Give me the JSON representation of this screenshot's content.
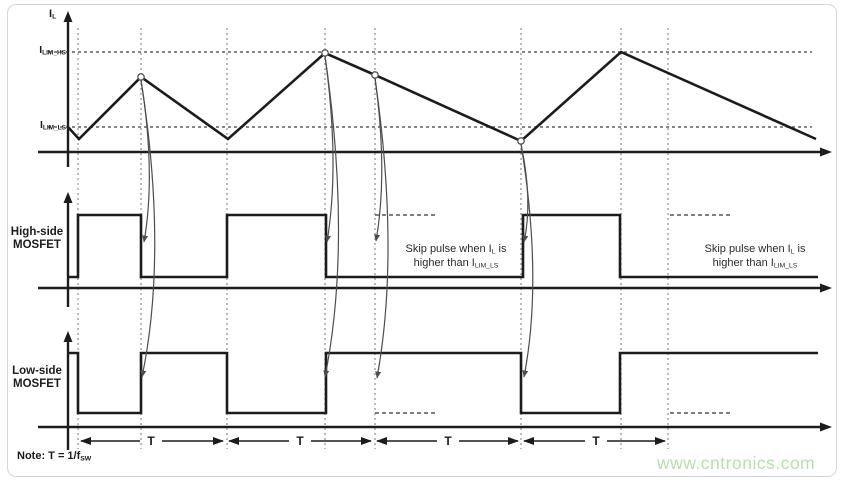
{
  "figure": {
    "il_axis": {
      "main": "I",
      "sub": "L"
    },
    "ilim_hs": {
      "main": "I",
      "sub": "LIM_HS"
    },
    "ilim_ls": {
      "main": "I",
      "sub": "LIM_LS"
    },
    "hs_label": {
      "line1": "High-side",
      "line2": "MOSFET"
    },
    "ls_label": {
      "line1": "Low-side",
      "line2": "MOSFET"
    },
    "skip_note": {
      "line1_pre": "Skip pulse when I",
      "line1_sub": "L",
      "line1_post": " is",
      "line2_pre": "higher than I",
      "line2_sub": "LIM_LS"
    },
    "note": {
      "pre": "Note: T = 1/f",
      "sub": "SW"
    },
    "t_label": "T",
    "watermark": "www.cntronics.com"
  },
  "colors": {
    "line": "#1c1c1c",
    "grid": "#8c8c8c",
    "limit_dash": "#5f5f5f",
    "skip_dash": "#555555",
    "curve": "#4d4d4d",
    "marker_stroke": "#555555",
    "watermark": "#b8dfac",
    "border": "#d6d6d6"
  },
  "geometry": {
    "width": 843,
    "height": 482,
    "vlines": {
      "xs": [
        78,
        141,
        227,
        325,
        375,
        521,
        621,
        668
      ],
      "y1": 28,
      "y2": 449
    },
    "limit_lines": [
      {
        "y": 52,
        "x1": 48,
        "x2": 812
      },
      {
        "y": 127,
        "x1": 48,
        "x2": 812
      }
    ],
    "axes": [
      {
        "ox": 68,
        "oy": 152,
        "ytop": 11,
        "ybot": 167,
        "x1": 38,
        "x2": 832
      },
      {
        "ox": 68,
        "oy": 288,
        "ytop": 192,
        "ybot": 307,
        "x1": 38,
        "x2": 832
      },
      {
        "ox": 68,
        "oy": 427,
        "ytop": 331,
        "ybot": 450,
        "x1": 38,
        "x2": 832
      }
    ],
    "il_wave": [
      [
        68,
        127
      ],
      [
        79,
        139
      ],
      [
        141,
        77
      ],
      [
        228,
        139
      ],
      [
        325,
        53
      ],
      [
        375,
        75
      ],
      [
        521,
        141
      ],
      [
        621,
        52
      ],
      [
        816,
        139
      ]
    ],
    "markers": [
      [
        141,
        77
      ],
      [
        325,
        53
      ],
      [
        375,
        75
      ],
      [
        521,
        141
      ]
    ],
    "hs_wave": [
      [
        68,
        277
      ],
      [
        78,
        277
      ],
      [
        78,
        215
      ],
      [
        141,
        215
      ],
      [
        141,
        277
      ],
      [
        227,
        277
      ],
      [
        227,
        215
      ],
      [
        326,
        215
      ],
      [
        326,
        277
      ],
      [
        523,
        277
      ],
      [
        523,
        215
      ],
      [
        620,
        215
      ],
      [
        620,
        277
      ],
      [
        818,
        277
      ]
    ],
    "ls_wave": [
      [
        68,
        353
      ],
      [
        78,
        353
      ],
      [
        78,
        413
      ],
      [
        141,
        413
      ],
      [
        141,
        353
      ],
      [
        227,
        353
      ],
      [
        227,
        413
      ],
      [
        326,
        413
      ],
      [
        326,
        353
      ],
      [
        521,
        353
      ],
      [
        521,
        413
      ],
      [
        620,
        413
      ],
      [
        620,
        353
      ],
      [
        818,
        353
      ]
    ],
    "skip_dashes": [
      {
        "y": 215,
        "x1": 375,
        "x2": 437
      },
      {
        "y": 215,
        "x1": 670,
        "x2": 731
      },
      {
        "y": 413,
        "x1": 375,
        "x2": 437
      },
      {
        "y": 413,
        "x1": 670,
        "x2": 730
      }
    ],
    "curves": [
      {
        "from": [
          141,
          80
        ],
        "to": [
          144,
          242
        ],
        "bulge": 15
      },
      {
        "from": [
          141,
          80
        ],
        "to": [
          142,
          377
        ],
        "bulge": 27
      },
      {
        "from": [
          325,
          56
        ],
        "to": [
          327,
          242
        ],
        "bulge": 15
      },
      {
        "from": [
          325,
          56
        ],
        "to": [
          325,
          377
        ],
        "bulge": 27
      },
      {
        "from": [
          375,
          78
        ],
        "to": [
          376,
          241
        ],
        "bulge": 13
      },
      {
        "from": [
          375,
          78
        ],
        "to": [
          377,
          378
        ],
        "bulge": 25
      },
      {
        "from": [
          521,
          144
        ],
        "to": [
          524,
          242
        ],
        "bulge": 12
      },
      {
        "from": [
          521,
          144
        ],
        "to": [
          524,
          377
        ],
        "bulge": 22
      }
    ],
    "t_arrows": [
      {
        "x1": 80,
        "x2": 224,
        "y": 441,
        "lx": 151
      },
      {
        "x1": 228,
        "x2": 372,
        "y": 441,
        "lx": 300
      },
      {
        "x1": 376,
        "x2": 519,
        "y": 441,
        "lx": 448
      },
      {
        "x1": 523,
        "x2": 666,
        "y": 441,
        "lx": 596
      }
    ]
  }
}
